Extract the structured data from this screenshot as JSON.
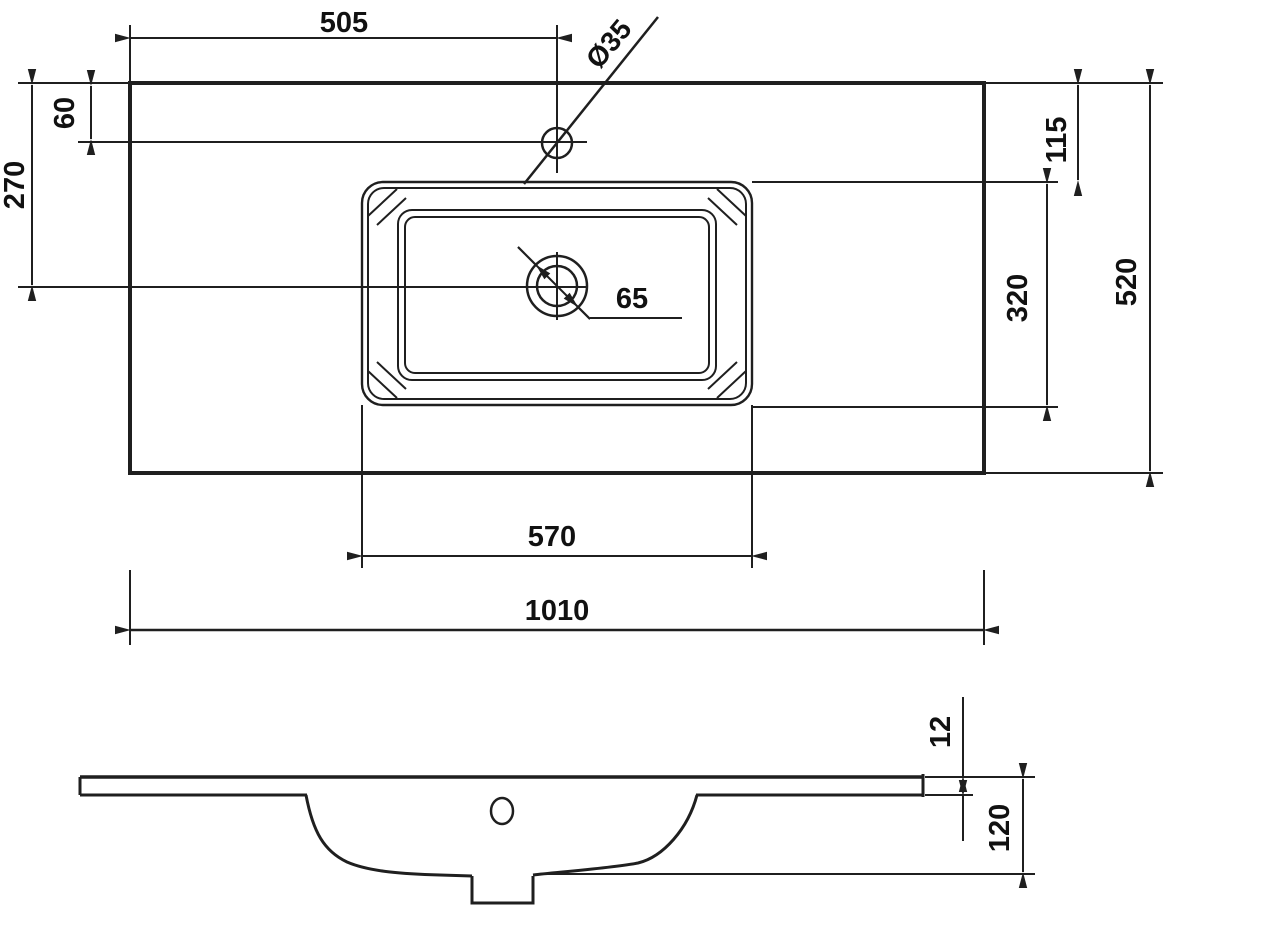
{
  "dims": {
    "d505": "505",
    "d60": "60",
    "d270": "270",
    "d35": "Ø35",
    "d65": "65",
    "d115": "115",
    "d320": "320",
    "d520": "520",
    "d570": "570",
    "d1010": "1010",
    "d12": "12",
    "d120": "120"
  },
  "line_color": "#1f1f1f"
}
